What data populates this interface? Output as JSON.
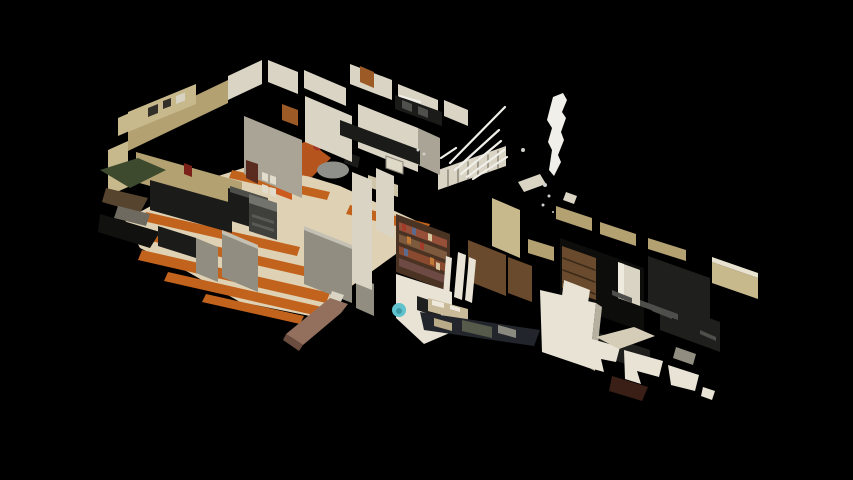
{
  "meta": {
    "description": "3D dollhouse overview of a textured office interior scan floating on a black background; isometric cutaway with no visible UI chrome or text",
    "render_type": "textured-3d-scan-dollhouse",
    "background_color": "#000000"
  },
  "viewport": {
    "width_px": 853,
    "height_px": 480
  },
  "palette": {
    "background": "#000000",
    "floor_cream": "#dfd2b4",
    "floor_orange": "#c2631d",
    "accent_orange": "#cd5a1e",
    "wall_tan": "#b3a172",
    "wall_khaki": "#c7b98c",
    "wall_light": "#d9d4c4",
    "wall_bright": "#e8e3d4",
    "wall_grey": "#a9a496",
    "partition_grey": "#918e81",
    "furniture_dark": "#1b1b19",
    "furniture_grey": "#4e4e4a",
    "floor_brown": "#93705e",
    "wood_brown": "#6a4a2c",
    "door_wood": "#9c5a26",
    "teal_accent": "#5fc2cc",
    "scan_light": "#f0efe9",
    "chair_red": "#a03524",
    "alarm_red": "#7a2018",
    "clutter_navy": "#23252d",
    "panel_shade": "#b5b0a0",
    "tabletop_cream": "#d6cdb8"
  },
  "scene": {
    "view": "dollhouse",
    "subject": "office interior 3D scan",
    "areas": [
      {
        "id": "left-office",
        "label": "cubicle office with orange striped carpet, desks and copier"
      },
      {
        "id": "upper-rooms",
        "label": "upper hallway and small offices with wood doors"
      },
      {
        "id": "center-rooms",
        "label": "storage room with full bookshelf and cluttered desks"
      },
      {
        "id": "right-dark-room",
        "label": "dimly scanned office with beige wall band and leaning white panel"
      },
      {
        "id": "corridor",
        "label": "brown entry corridor stub"
      },
      {
        "id": "ceiling-lights",
        "label": "blown-out ceiling light streaks and vertical light blob"
      }
    ]
  }
}
